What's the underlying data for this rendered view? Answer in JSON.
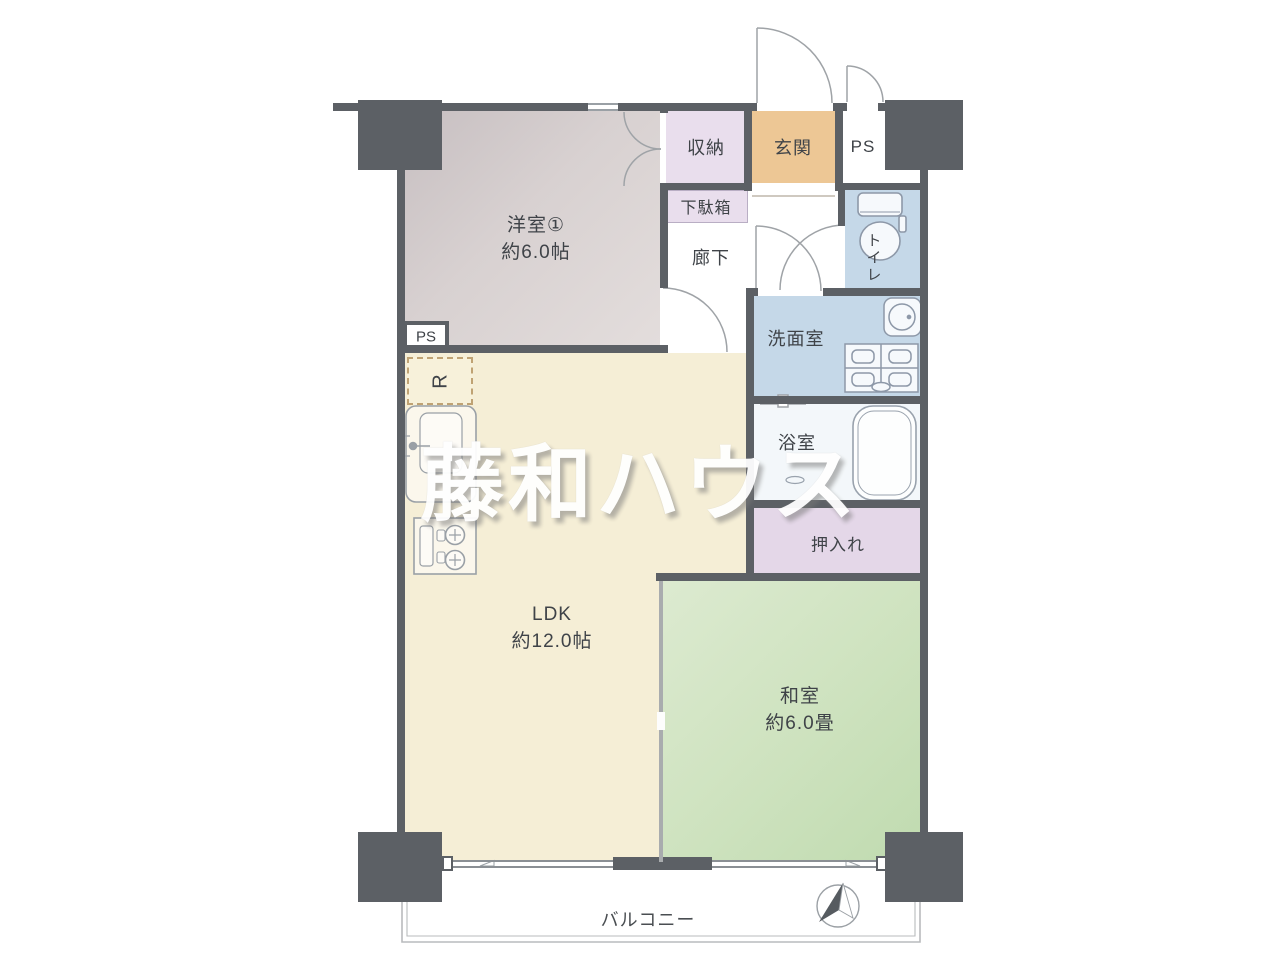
{
  "floor_plan": {
    "watermark": "藤和ハウス",
    "rooms": {
      "western_room": {
        "name": "洋室①",
        "size": "約6.0帖"
      },
      "ldk": {
        "name": "LDK",
        "size": "約12.0帖"
      },
      "japanese_room": {
        "name": "和室",
        "size": "約6.0畳"
      },
      "storage": {
        "name": "収納"
      },
      "entrance": {
        "name": "玄関"
      },
      "pipe_space_top": {
        "name": "PS"
      },
      "shoe_cabinet": {
        "name": "下駄箱"
      },
      "hallway": {
        "name": "廊下"
      },
      "toilet": {
        "name": "トイレ"
      },
      "washroom": {
        "name": "洗面室"
      },
      "bathroom": {
        "name": "浴室"
      },
      "closet": {
        "name": "押入れ"
      },
      "pipe_space_kitchen": {
        "name": "PS"
      },
      "refrigerator_space": {
        "name": "R"
      },
      "balcony": {
        "name": "バルコニー"
      }
    },
    "colors": {
      "wall": "#5c6065",
      "western_room": "#d6cfcf",
      "ldk": "#f5eed6",
      "japanese_room": "#cbe0bc",
      "storage_lavender": "#e9deed",
      "closet_lavender": "#e4d7e8",
      "entrance_orange": "#edc795",
      "sanitary_blue": "#c5d8e8",
      "bathroom": "#f3f7fa",
      "balcony_line": "#b9bbbd"
    }
  }
}
